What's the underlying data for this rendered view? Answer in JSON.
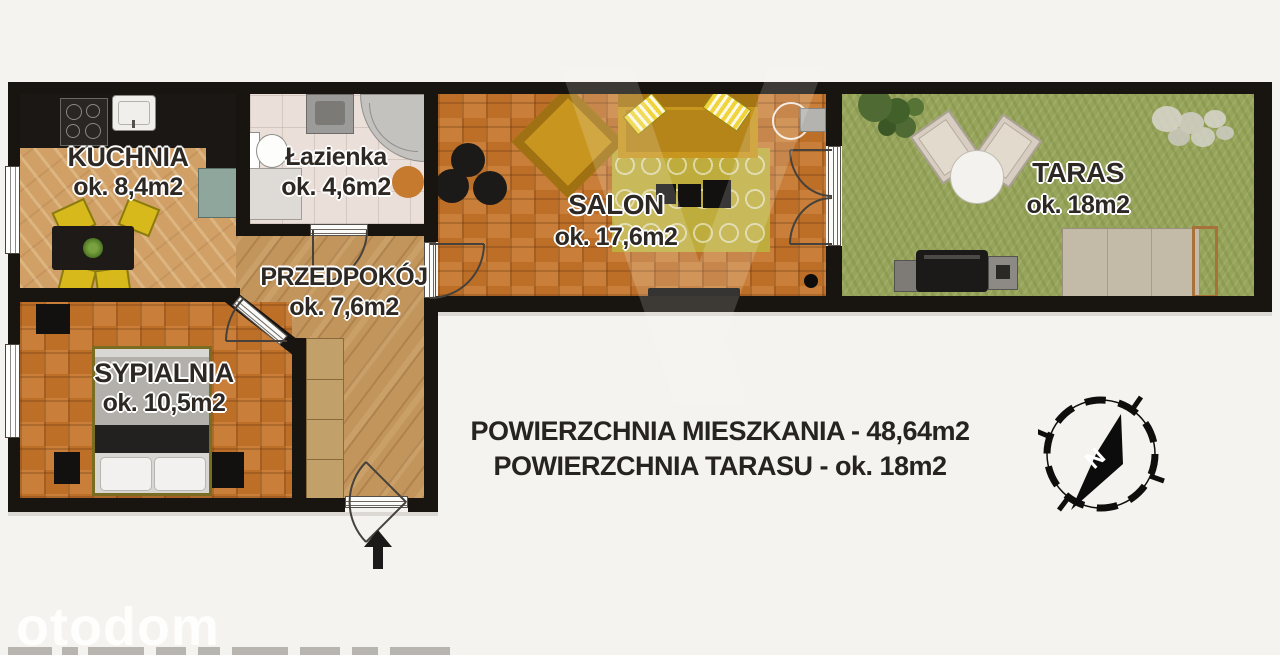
{
  "plan": {
    "rooms": [
      {
        "name": "KUCHNIA",
        "area": "ok. 8,4m2"
      },
      {
        "name": "Łazienka",
        "area": "ok. 4,6m2"
      },
      {
        "name": "PRZEDPOKÓJ",
        "area": "ok. 7,6m2"
      },
      {
        "name": "SALON",
        "area": "ok. 17,6m2"
      },
      {
        "name": "SYPIALNIA",
        "area": "ok. 10,5m2"
      },
      {
        "name": "TARAS",
        "area": "ok. 18m2"
      }
    ],
    "compass": {
      "north_label": "N"
    }
  },
  "summary": {
    "apartment_area": "POWIERZCHNIA MIESZKANIA - 48,64m2",
    "terrace_area": "POWIERZCHNIA TARASU - ok. 18m2"
  },
  "watermark": {
    "brand": "otodom"
  },
  "colors": {
    "background": "#f5f3ef",
    "wall": "#18140f",
    "parquet": "#c57b2f",
    "kitchen_floor": "#d0a066",
    "hall_floor": "#c2955c",
    "bath_floor": "#eadfd9",
    "grass": "#97a45b",
    "furniture_yellow": "#c8961f",
    "rug_olive": "#beac3c",
    "label_text": "#2d2823"
  }
}
